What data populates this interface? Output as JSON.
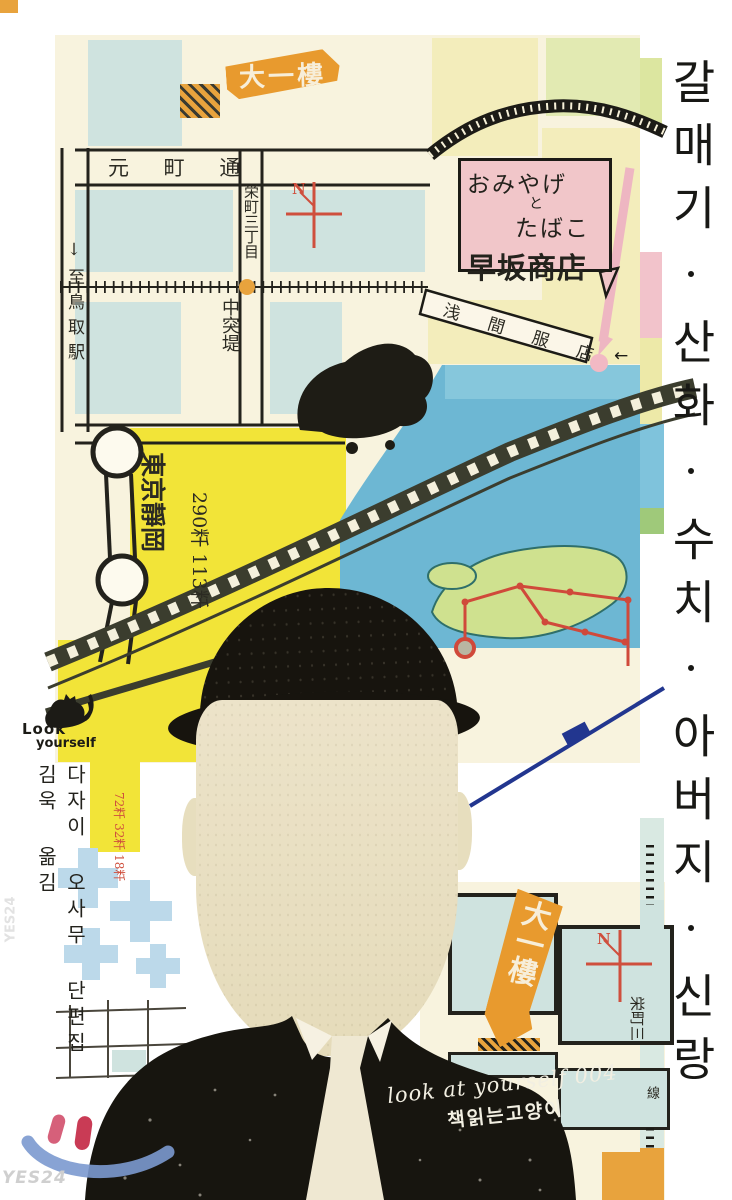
{
  "cover": {
    "title_vertical": "갈매기·산화·수치·아버지·신랑",
    "author_line": "다자이 오사무 단편집 김욱 옮김",
    "series_label": "look at yourself 004",
    "publisher": "책읽는고양이",
    "logo_line1": "Look",
    "logo_line2": "yourself"
  },
  "map_labels": {
    "banner_top": "大一樓",
    "banner_bottom": "大一樓",
    "street_top": "元 町 通",
    "street_vertical": "栄町三丁目",
    "pier": "中突堤",
    "to_station": "↓至鳥取駅",
    "cities": "東京靜岡",
    "distances": "290粁 113粁",
    "red_distances": "72粁 32粁 18粁",
    "shop_line1": "おみやげ",
    "shop_line2": "と",
    "shop_line3": "たばこ",
    "shop_line4": "早坂商店",
    "diagonal_shop": "浅 間 服 店",
    "district_small": "栄町三",
    "thread_left": "綿",
    "thread_right": "線",
    "compass_top": "N",
    "compass_bottom": "N",
    "arrow_left": "←"
  },
  "watermark": {
    "store": "YES24",
    "store_side": "YES24"
  },
  "colors": {
    "cream": "#f8f3de",
    "block_blue": "#cfe3df",
    "bright_yellow": "#f2e438",
    "pale_yellow": "#f3edbb",
    "pale_green": "#e2eab2",
    "sea_blue": "#6db7d3",
    "land_green": "#cfe18f",
    "pink": "#f1c6c9",
    "orange": "#e89a2e",
    "red": "#cf4f3d",
    "navy": "#22368f",
    "suit_black": "#17150f",
    "face_beige": "#e9e0c5"
  }
}
